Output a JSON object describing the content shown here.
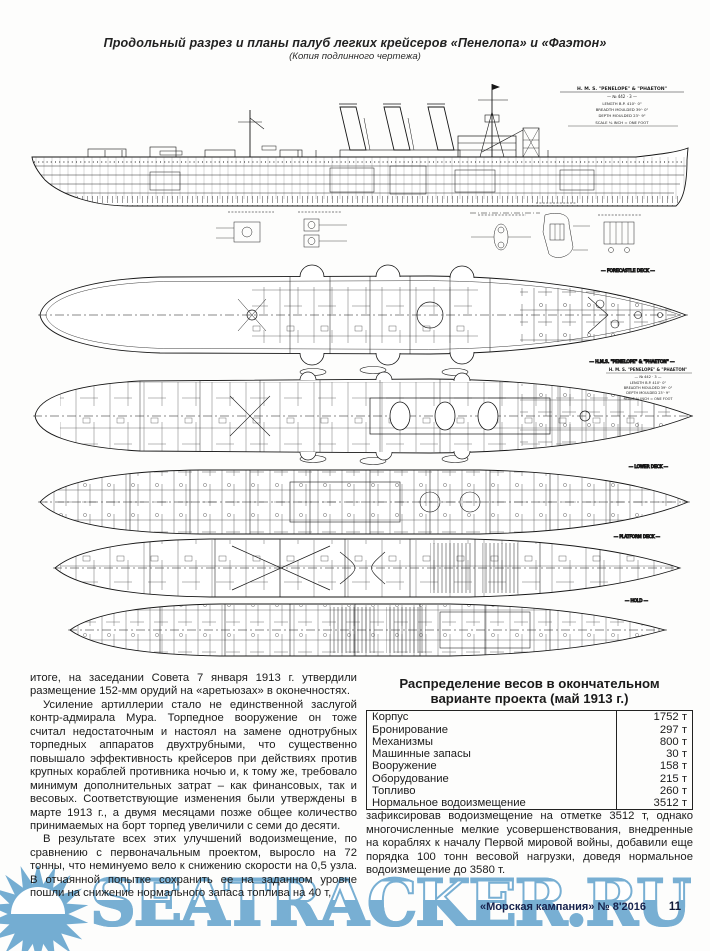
{
  "header": {
    "title": "Продольный разрез и планы палуб легких крейсеров «Пенелопа» и «Фаэтон»",
    "subtitle": "(Копия подлинного чертежа)"
  },
  "drawing": {
    "title_block": [
      "H. M. S. \"PENELOPE\" & \"PHAETON\"",
      "— № 442 · 3 —",
      "LENGTH  B.P.  410'· 0\"",
      "BREADTH  MOULDED  39'· 0\"",
      "DEPTH  MOULDED  23'· 9\"",
      "SCALE ⅛ INCH = ONE FOOT"
    ],
    "plan_title_block": [
      "H. M. S. \"PENELOPE\" & \"PHAETON\"",
      "— № 442 · 3 —",
      "LENGTH  B.P.  410'· 0\"",
      "BREADTH  MOULDED  39'· 0\"",
      "DEPTH  MOULDED  23'· 9\"",
      "SCALE ⅛ INCH = ONE FOOT"
    ],
    "labels": {
      "plan1": "— FORECASTLE  DECK —",
      "plan1_caption": "— H.M.S. \"PENELOPE\" & \"PHAETON\" —",
      "plan3": "— LOWER  DECK —",
      "plan4": "— PLATFORM  DECK —",
      "plan5": "— HOLD —"
    }
  },
  "article": {
    "left": {
      "p1": "итоге, на заседании Совета 7 января 1913 г. утвердили размещение 152-мм орудий на «аретьюзах» в оконечностях.",
      "p2": "Усиление артиллерии стало не единственной заслугой контр-адмирала Мура. Торпедное вооружение он тоже считал недостаточным и настоял на замене однотрубных торпедных аппаратов двухтрубными, что существенно повышало эффективность крейсеров при действиях против крупных кораблей противника ночью и, к тому же, требовало минимум дополнительных затрат – как финансовых, так и весовых. Соответствующие изменения были утверждены в марте 1913 г., а двумя месяцами позже общее количество принимаемых на борт торпед увеличили с семи до десяти.",
      "p3": "В результате всех этих улучшений водоизмещение, по сравнению с первоначальным проектом, выросло на 72 тонны, что неминуемо вело к снижению скорости на 0,5 узла. В отчаянной попытке сохранить ее на заданном уровне пошли на снижение нормального запаса топлива на 40 т,"
    },
    "right": {
      "p1": "зафиксировав водоизмещение на отметке 3512 т, однако многочисленные мелкие усовершенствования, внедренные на кораблях к началу Первой мировой войны, добавили еще порядка 100 тонн весовой нагрузки, доведя нормальное водоизмещение до 3580 т."
    }
  },
  "table": {
    "title_line1": "Распределение весов в окончательном",
    "title_line2": "варианте проекта (май 1913 г.)",
    "rows": [
      {
        "label": "Корпус",
        "value": "1752 т"
      },
      {
        "label": "Бронирование",
        "value": "297 т"
      },
      {
        "label": "Механизмы",
        "value": "800 т"
      },
      {
        "label": "Машинные запасы",
        "value": "30 т"
      },
      {
        "label": "Вооружение",
        "value": "158 т"
      },
      {
        "label": "Оборудование",
        "value": "215 т"
      },
      {
        "label": "Топливо",
        "value": "260 т"
      },
      {
        "label": "Нормальное водоизмещение",
        "value": "3512 т"
      }
    ]
  },
  "watermark": {
    "text": "SEATRACKER.RU",
    "color": "#78afd3"
  },
  "footer": {
    "journal": "«Морская кампания» № 8'2016",
    "page": "11"
  }
}
